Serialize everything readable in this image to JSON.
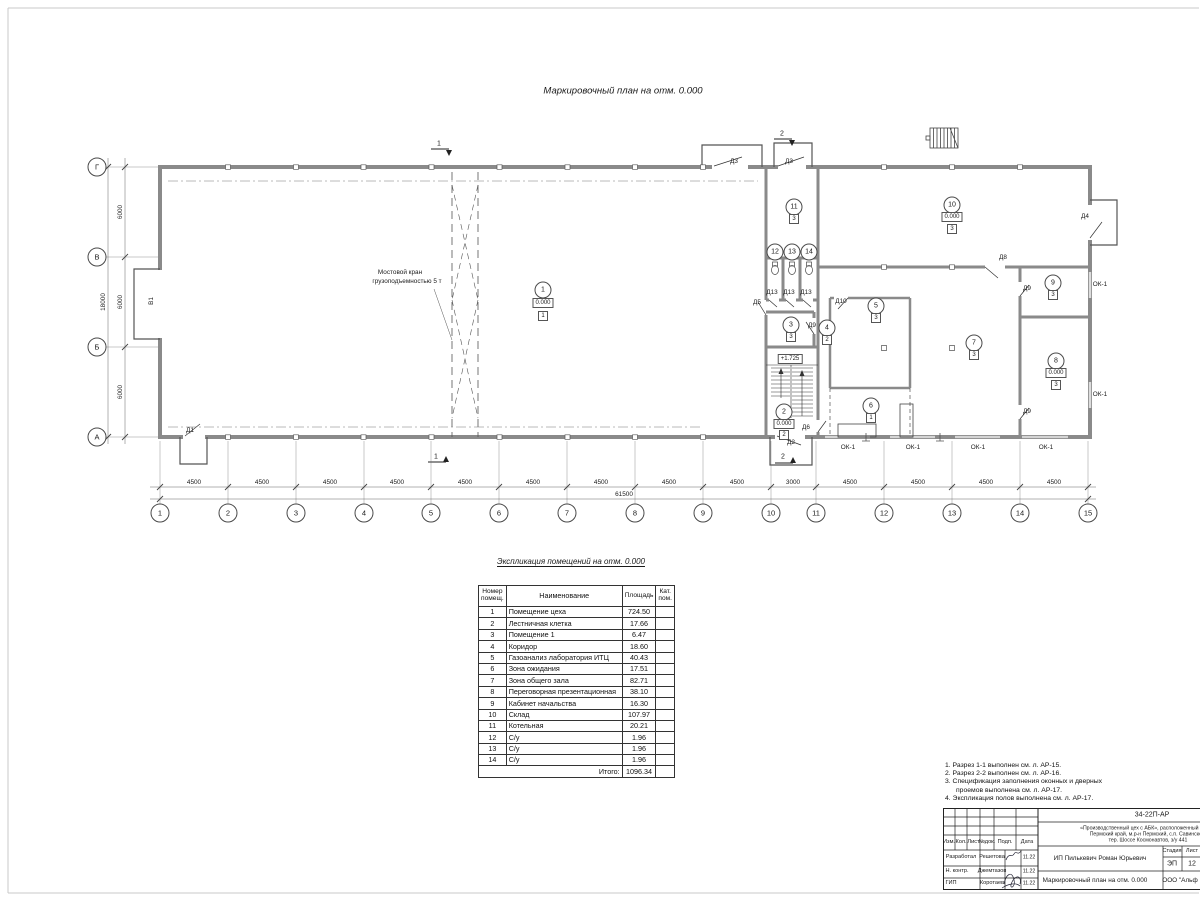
{
  "titles": {
    "plan": "Маркировочный план  на отм. 0.000",
    "schedule": "Экспликация помещений на отм. 0.000"
  },
  "plan": {
    "axes_bottom": [
      "1",
      "2",
      "3",
      "4",
      "5",
      "6",
      "7",
      "8",
      "9",
      "10",
      "11",
      "12",
      "13",
      "14",
      "15"
    ],
    "axes_left": [
      "Г",
      "В",
      "Б",
      "А"
    ],
    "dims_bottom": [
      "4500",
      "4500",
      "4500",
      "4500",
      "4500",
      "4500",
      "4500",
      "4500",
      "4500",
      "3000",
      "4500",
      "4500",
      "4500",
      "4500"
    ],
    "dim_total_bottom": "61500",
    "dims_left": [
      "6000",
      "6000",
      "6000"
    ],
    "dim_total_left": "18000",
    "crane_line1": "Мостовой кран",
    "crane_line2": "грузоподъемностью 5 т",
    "gate": "В1",
    "stair_level": "+1.725",
    "sections": [
      "1",
      "1",
      "2",
      "2"
    ],
    "rooms": [
      {
        "num": "1",
        "elev": "0.000",
        "type": "1"
      },
      {
        "num": "2",
        "elev": "0.000",
        "type": "2"
      },
      {
        "num": "3",
        "type": "3"
      },
      {
        "num": "4",
        "type": "2"
      },
      {
        "num": "5",
        "type": "3"
      },
      {
        "num": "6",
        "type": "1"
      },
      {
        "num": "7",
        "type": "3"
      },
      {
        "num": "8",
        "elev": "0.000",
        "type": "3"
      },
      {
        "num": "9",
        "type": "3"
      },
      {
        "num": "10",
        "elev": "0.000",
        "type": "3"
      },
      {
        "num": "11",
        "type": "3"
      },
      {
        "num": "12"
      },
      {
        "num": "13"
      },
      {
        "num": "14"
      }
    ],
    "doors": [
      "Д1",
      "Д2",
      "Д3",
      "Д3",
      "Д4",
      "Д5",
      "Д6",
      "Д8",
      "Д9",
      "Д9",
      "Д9",
      "Д10",
      "Д13",
      "Д13",
      "Д13"
    ],
    "windows": [
      "ОК-1",
      "ОК-1",
      "ОК-1",
      "ОК-1",
      "ОК-1",
      "ОК-1"
    ]
  },
  "schedule": {
    "headers": [
      "Номер помещ.",
      "Наименование",
      "Площадь",
      "Кат. пом."
    ],
    "rows": [
      [
        "1",
        "Помещение цеха",
        "724.50"
      ],
      [
        "2",
        "Лестничная клетка",
        "17.66"
      ],
      [
        "3",
        "Помещение 1",
        "6.47"
      ],
      [
        "4",
        "Коридор",
        "18.60"
      ],
      [
        "5",
        "Газоанализ лаборатория ИТЦ",
        "40.43"
      ],
      [
        "6",
        "Зона ожидания",
        "17.51"
      ],
      [
        "7",
        "Зона общего зала",
        "82.71"
      ],
      [
        "8",
        "Переговорная презентационная",
        "38.10"
      ],
      [
        "9",
        "Кабинет начальства",
        "16.30"
      ],
      [
        "10",
        "Склад",
        "107.97"
      ],
      [
        "11",
        "Котельная",
        "20.21"
      ],
      [
        "12",
        "С/у",
        "1.96"
      ],
      [
        "13",
        "С/у",
        "1.96"
      ],
      [
        "14",
        "С/у",
        "1.96"
      ]
    ],
    "total_label": "Итого:",
    "total_value": "1096.34"
  },
  "notes": [
    "1. Разрез 1-1 выполнен см. л. АР-15.",
    "2. Разрез 2-2 выполнен см. л. АР-16.",
    "3. Спецификация заполнения оконных и дверных",
    "проемов выполнена см. л. АР-17.",
    "4. Экспликация полов выполнена см. л. АР-17."
  ],
  "stamp": {
    "code": "34-22П-АР",
    "desc1": "«Производственный цех с АБК», расположенный по адр",
    "desc2": "Пермский край, м.р-н Пермский, с.п. Савинское,",
    "desc3": "тер. Шоссе Космонавтов, з/у 441",
    "cols": [
      "Изм.",
      "Кол.",
      "Лист",
      "№док.",
      "Подп.",
      "Дата"
    ],
    "rows": [
      {
        "role": "Разработал",
        "name": "Решетова",
        "date": "11.22"
      },
      {
        "role": "Н. контр.",
        "name": "Джемтазов",
        "date": "11.22"
      },
      {
        "role": "ГИП",
        "name": "Коротаев",
        "date": "11.22"
      }
    ],
    "client": "ИП Пилькевич Роман Юрьевич",
    "stage_label": "Стадия",
    "sheet_label": "Лист",
    "stage": "ЭП",
    "sheet": "12",
    "doc_title": "Маркировочный план на отм. 0.000",
    "org": "ООО \"Альф"
  }
}
